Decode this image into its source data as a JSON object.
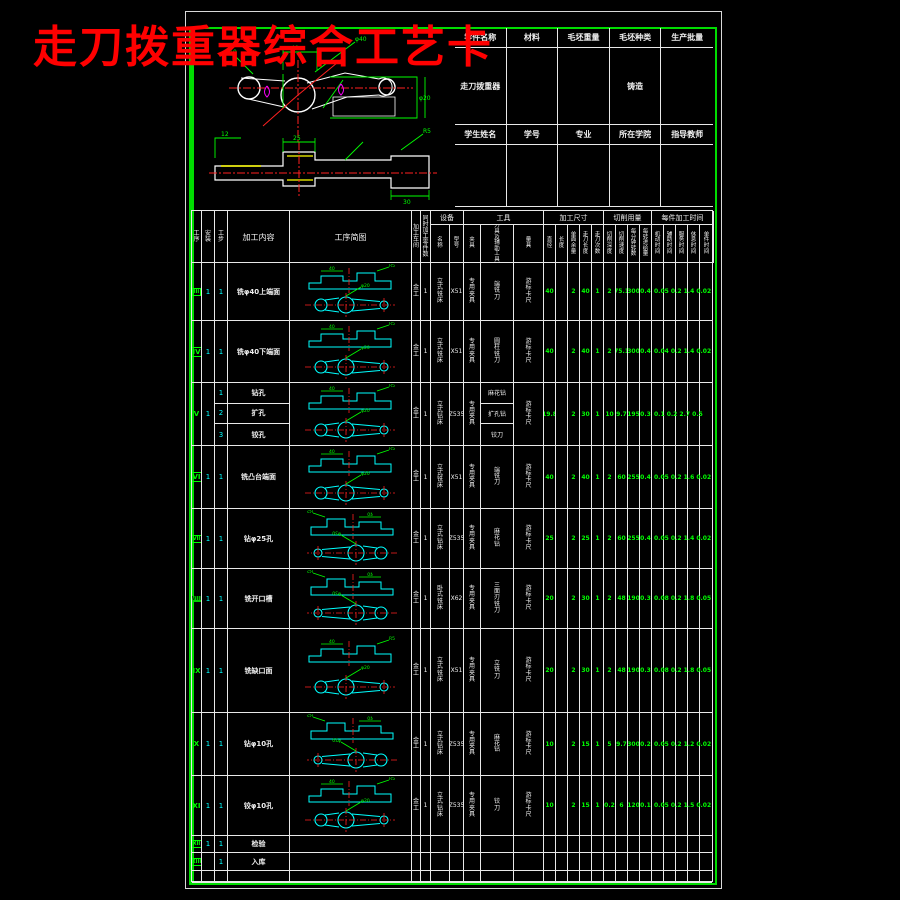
{
  "page": {
    "title": "走刀拨重器综合工艺卡"
  },
  "colors": {
    "bg": "#000000",
    "frame_green": "#00dc00",
    "line_white": "#e8e8e8",
    "title_red": "#ff0000",
    "part_cyan": "#00ffff",
    "dim_green": "#00ff00",
    "center_red": "#ff2020",
    "gdt_magenta": "#ff00ff",
    "hilite_yellow": "#ffff00"
  },
  "info_table": {
    "header1": [
      "零件名称",
      "材料",
      "毛坯重量",
      "毛坯种类",
      "生产批量"
    ],
    "row1": [
      "走刀拨重器",
      "",
      "",
      "铸造",
      ""
    ],
    "header2": [
      "学生姓名",
      "学号",
      "专业",
      "所在学院",
      "指导教师"
    ],
    "row2": [
      "",
      "",
      "",
      "",
      ""
    ]
  },
  "drawing": {
    "labels_top": [
      "40",
      "R10",
      "φ20",
      "φ40"
    ],
    "labels_bottom": [
      "25",
      "12",
      "R5",
      "30"
    ]
  },
  "process_table": {
    "columns": [
      {
        "label": "工序",
        "w": 10,
        "v": true,
        "group": ""
      },
      {
        "label": "安装",
        "w": 13,
        "v": true,
        "group": ""
      },
      {
        "label": "工步",
        "w": 13,
        "v": true,
        "group": ""
      },
      {
        "label": "加工内容",
        "w": 62,
        "v": false,
        "group": ""
      },
      {
        "label": "工序简图",
        "w": 122,
        "v": false,
        "group": ""
      },
      {
        "label": "加工车间",
        "w": 9,
        "v": true,
        "group": ""
      },
      {
        "label": "同时加工零件数",
        "w": 10,
        "v": true,
        "group": ""
      },
      {
        "label": "名称",
        "w": 19,
        "v": true,
        "group": "设备"
      },
      {
        "label": "型号",
        "w": 14,
        "v": true,
        "group": "设备"
      },
      {
        "label": "夹具",
        "w": 17,
        "v": true,
        "group": "工具"
      },
      {
        "label": "刀具及辅助工具",
        "w": 33,
        "v": true,
        "group": "工具"
      },
      {
        "label": "量具",
        "w": 30,
        "v": true,
        "group": "工具"
      },
      {
        "label": "直径",
        "w": 12,
        "v": true,
        "group": "加工尺寸"
      },
      {
        "label": "长度",
        "w": 12,
        "v": true,
        "group": "加工尺寸"
      },
      {
        "label": "单面余量",
        "w": 12,
        "v": true,
        "group": "加工尺寸"
      },
      {
        "label": "走刀长度",
        "w": 12,
        "v": true,
        "group": "加工尺寸"
      },
      {
        "label": "走刀次数",
        "w": 12,
        "v": true,
        "group": "加工尺寸"
      },
      {
        "label": "切削深度",
        "w": 12,
        "v": true,
        "group": "切削用量"
      },
      {
        "label": "切削速度",
        "w": 12,
        "v": true,
        "group": "切削用量"
      },
      {
        "label": "每分钟转数",
        "w": 12,
        "v": true,
        "group": "切削用量"
      },
      {
        "label": "每转进给量",
        "w": 12,
        "v": true,
        "group": "切削用量"
      },
      {
        "label": "机动时间",
        "w": 12,
        "v": true,
        "group": "每件加工时间"
      },
      {
        "label": "辅助时间",
        "w": 12,
        "v": true,
        "group": "每件加工时间"
      },
      {
        "label": "服务时间",
        "w": 12,
        "v": true,
        "group": "每件加工时间"
      },
      {
        "label": "休息时间",
        "w": 12,
        "v": true,
        "group": "每件加工时间"
      },
      {
        "label": "单件时间",
        "w": 14,
        "v": true,
        "group": "每件加工时间"
      }
    ],
    "rows": [
      {
        "seq": "III",
        "mark": "box",
        "h": 58,
        "setup": "1",
        "sketch": true,
        "tall": false,
        "flip": false,
        "steps": [
          {
            "no": "1",
            "content": "铣φ40上端面",
            "tool": "端铣刀"
          }
        ],
        "workshop": "金工",
        "qty": "1",
        "equipment": "立式铣床",
        "model": "X51",
        "fixture": "专用夹具",
        "gauge": "游标卡尺",
        "values": [
          "40",
          "",
          "2",
          "40",
          "1",
          "2",
          "75.1",
          "300",
          "0.4"
        ],
        "times": "0.05 0.2 1.4 0.02"
      },
      {
        "seq": "IV",
        "mark": "box",
        "h": 62,
        "setup": "1",
        "sketch": true,
        "tall": false,
        "flip": false,
        "steps": [
          {
            "no": "1",
            "content": "铣φ40下端面",
            "tool": "圆柱铣刀"
          }
        ],
        "workshop": "金工",
        "qty": "1",
        "equipment": "立式铣床",
        "model": "X51",
        "fixture": "专用夹具",
        "gauge": "游标卡尺",
        "values": [
          "40",
          "",
          "2",
          "40",
          "1",
          "2",
          "75.1",
          "300",
          "0.4"
        ],
        "times": "0.04 0.2 1.4 0.02"
      },
      {
        "seq": "V",
        "mark": "",
        "h": 63,
        "setup": "1",
        "sketch": true,
        "tall": false,
        "flip": false,
        "steps": [
          {
            "no": "1",
            "content": "钻孔",
            "tool": "麻花钻"
          },
          {
            "no": "2",
            "content": "扩孔",
            "tool": "扩孔钻"
          },
          {
            "no": "3",
            "content": "铰孔",
            "tool": "铰刀"
          }
        ],
        "workshop": "金工",
        "qty": "1",
        "equipment": "立式钻床",
        "model": "Z535",
        "fixture": "专用夹具",
        "gauge": "游标卡尺",
        "values": [
          "19.8",
          "",
          "2",
          "30",
          "1",
          "10",
          "9.7",
          "195",
          "0.3"
        ],
        "times": "0.1 0.2 2.7 0.5"
      },
      {
        "seq": "VI",
        "mark": "box",
        "h": 63,
        "setup": "1",
        "sketch": true,
        "tall": false,
        "flip": false,
        "steps": [
          {
            "no": "1",
            "content": "铣凸台端面",
            "tool": "端铣刀"
          }
        ],
        "workshop": "金工",
        "qty": "1",
        "equipment": "立式铣床",
        "model": "X51",
        "fixture": "专用夹具",
        "gauge": "游标卡尺",
        "values": [
          "40",
          "",
          "2",
          "40",
          "1",
          "2",
          "60",
          "255",
          "0.4"
        ],
        "times": "0.05 0.2 1.6 0.02"
      },
      {
        "seq": "VII",
        "mark": "box",
        "h": 60,
        "setup": "1",
        "sketch": true,
        "tall": false,
        "flip": true,
        "steps": [
          {
            "no": "1",
            "content": "钻φ25孔",
            "tool": "麻花钻"
          }
        ],
        "workshop": "金工",
        "qty": "1",
        "equipment": "立式钻床",
        "model": "Z535",
        "fixture": "专用夹具",
        "gauge": "游标卡尺",
        "values": [
          "25",
          "",
          "2",
          "25",
          "1",
          "2",
          "60",
          "255",
          "0.4"
        ],
        "times": "0.05 0.2 1.4 0.02"
      },
      {
        "seq": "VIII",
        "mark": "fill",
        "h": 60,
        "setup": "1",
        "sketch": true,
        "tall": false,
        "flip": true,
        "steps": [
          {
            "no": "1",
            "content": "铣开口槽",
            "tool": "三面刃铣刀"
          }
        ],
        "workshop": "金工",
        "qty": "1",
        "equipment": "卧式铣床",
        "model": "X62",
        "fixture": "专用夹具",
        "gauge": "游标卡尺",
        "values": [
          "20",
          "",
          "2",
          "30",
          "1",
          "2",
          "48",
          "190",
          "0.3"
        ],
        "times": "0.08 0.2 1.8 0.05"
      },
      {
        "seq": "IX",
        "mark": "",
        "h": 84,
        "setup": "1",
        "sketch": true,
        "tall": true,
        "flip": false,
        "steps": [
          {
            "no": "1",
            "content": "铣缺口面",
            "tool": "立铣刀"
          }
        ],
        "workshop": "金工",
        "qty": "1",
        "equipment": "立式铣床",
        "model": "X51",
        "fixture": "专用夹具",
        "gauge": "游标卡尺",
        "values": [
          "20",
          "",
          "2",
          "30",
          "1",
          "2",
          "48",
          "190",
          "0.3"
        ],
        "times": "0.08 0.2 1.8 0.05"
      },
      {
        "seq": "X",
        "mark": "",
        "h": 63,
        "setup": "1",
        "sketch": true,
        "tall": false,
        "flip": true,
        "steps": [
          {
            "no": "1",
            "content": "钻φ10孔",
            "tool": "麻花钻"
          }
        ],
        "workshop": "金工",
        "qty": "1",
        "equipment": "立式钻床",
        "model": "Z535",
        "fixture": "专用夹具",
        "gauge": "游标卡尺",
        "values": [
          "10",
          "",
          "2",
          "15",
          "1",
          "5",
          "9.7",
          "300",
          "0.2"
        ],
        "times": "0.05 0.2 1.2 0.02"
      },
      {
        "seq": "XI",
        "mark": "",
        "h": 60,
        "setup": "1",
        "sketch": true,
        "tall": false,
        "flip": false,
        "steps": [
          {
            "no": "1",
            "content": "铰φ10孔",
            "tool": "铰刀"
          }
        ],
        "workshop": "金工",
        "qty": "1",
        "equipment": "立式钻床",
        "model": "Z535",
        "fixture": "专用夹具",
        "gauge": "游标卡尺",
        "values": [
          "10",
          "",
          "2",
          "15",
          "1",
          "0.2",
          "6",
          "120",
          "0.1"
        ],
        "times": "0.05 0.2 1.5 0.02"
      },
      {
        "seq": "XII",
        "mark": "box",
        "h": 17,
        "setup": "1",
        "sketch": false,
        "tall": false,
        "flip": false,
        "steps": [
          {
            "no": "1",
            "content": "检验",
            "tool": ""
          }
        ],
        "workshop": "",
        "qty": "",
        "equipment": "",
        "model": "",
        "fixture": "",
        "gauge": "",
        "values": [],
        "times": ""
      },
      {
        "seq": "XIII",
        "mark": "box",
        "h": 18,
        "setup": "",
        "sketch": false,
        "tall": false,
        "flip": false,
        "steps": [
          {
            "no": "1",
            "content": "入库",
            "tool": ""
          }
        ],
        "workshop": "",
        "qty": "",
        "equipment": "",
        "model": "",
        "fixture": "",
        "gauge": "",
        "values": [],
        "times": ""
      },
      {
        "seq": "",
        "mark": "",
        "h": 12,
        "setup": "",
        "sketch": false,
        "tall": false,
        "flip": false,
        "steps": [],
        "workshop": "",
        "qty": "",
        "equipment": "",
        "model": "",
        "fixture": "",
        "gauge": "",
        "values": [],
        "times": ""
      }
    ]
  }
}
